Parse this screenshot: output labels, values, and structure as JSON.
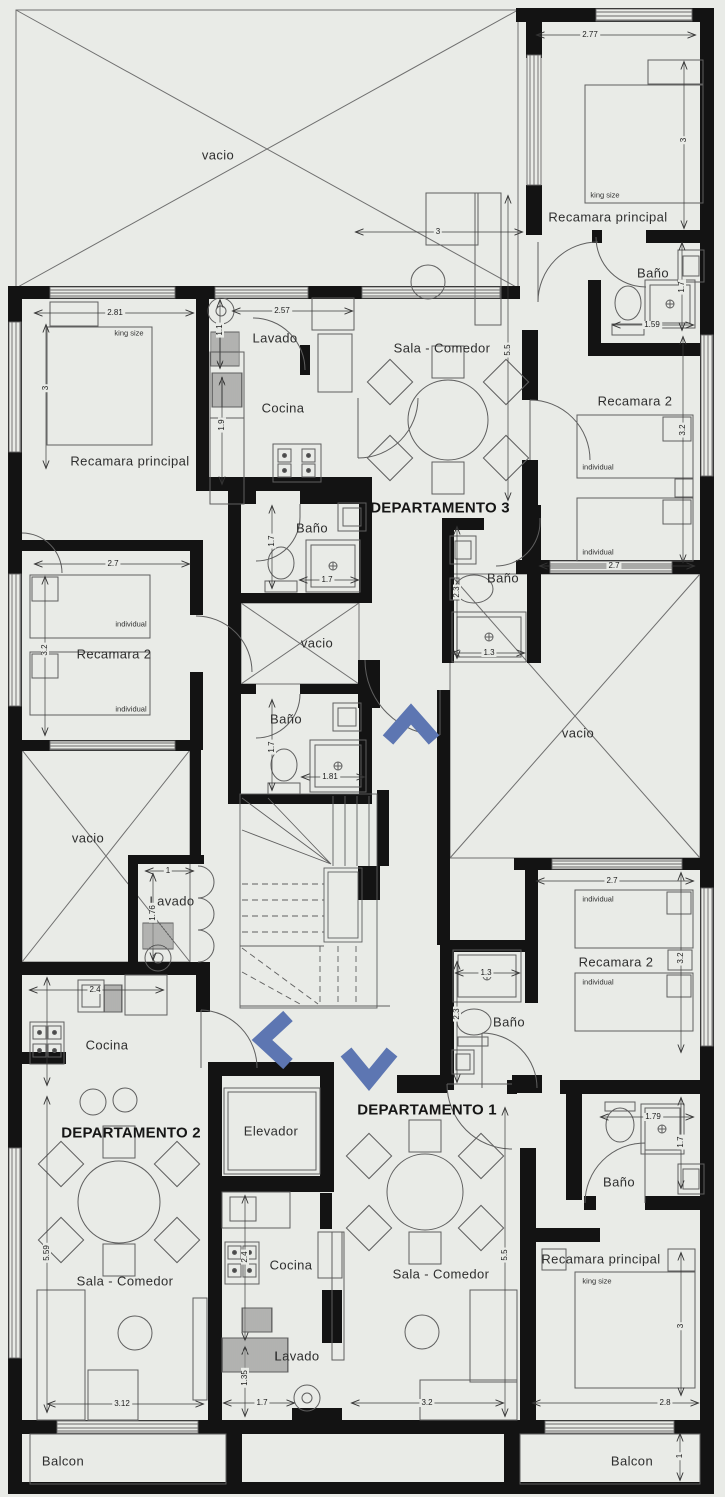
{
  "colors": {
    "background": "#e9ebe7",
    "walls": "#131313",
    "thin_lines": "#5f5f5f",
    "direction_arrow_blue": "#5d76b2",
    "text": "#2e2e2e"
  },
  "labels": {
    "departamento_1": "DEPARTAMENTO 1",
    "departamento_2": "DEPARTAMENTO 2",
    "departamento_3": "DEPARTAMENTO 3",
    "vacio": "vacio",
    "recamara_principal": "Recamara principal",
    "recamara_2": "Recamara 2",
    "bano": "Baño",
    "cocina": "Cocina",
    "lavado": "Lavado",
    "sala_comedor": "Sala - Comedor",
    "elevador": "Elevador",
    "balcon": "Balcon",
    "king_size": "king size",
    "individual": "individual"
  },
  "dimensions": {
    "recamara_principal_tr": {
      "w": "2.77",
      "h": "3"
    },
    "bano_tr": {
      "w": "1.59",
      "h": "1.7"
    },
    "recamara_2_tr": {
      "w": "2.7",
      "h": "3.2"
    },
    "sala_comedor_d3": {
      "w": "3",
      "h": "5.5"
    },
    "recamara_principal_left": {
      "w": "2.81",
      "h": "3"
    },
    "lavado_d3": {
      "w": "2.57",
      "h": "1.1"
    },
    "cocina_d3": {
      "h": "1.9"
    },
    "bano_mid_upper": {
      "w": "1.7",
      "h": "1.7"
    },
    "bano_d3": {
      "w": "1.3",
      "h": "2.3"
    },
    "bano_mid_lower": {
      "w": "1.81",
      "h": "1.7"
    },
    "recamara_2_left": {
      "w": "2.7",
      "h": "3.2"
    },
    "lavado_left": {
      "w": "1",
      "h": "1.76"
    },
    "cocina_d2": {
      "w": "2.4"
    },
    "sala_comedor_d2": {
      "w": "3.12",
      "h": "5.59"
    },
    "cocina_d1": {
      "h": "2.4"
    },
    "lavado_d1": {
      "w": "1.7",
      "h": "1.35"
    },
    "sala_comedor_d1": {
      "w": "3.2",
      "h": "5.5"
    },
    "recamara_2_d1": {
      "w": "2.7",
      "h": "3.2"
    },
    "bano_d1_small": {
      "w": "1.3",
      "h": "2.3"
    },
    "bano_d1_main": {
      "w": "1.79",
      "h": "1.7"
    },
    "recamara_principal_d1": {
      "w": "2.8",
      "h": "3"
    },
    "balcon_right": {
      "h": "1"
    }
  }
}
